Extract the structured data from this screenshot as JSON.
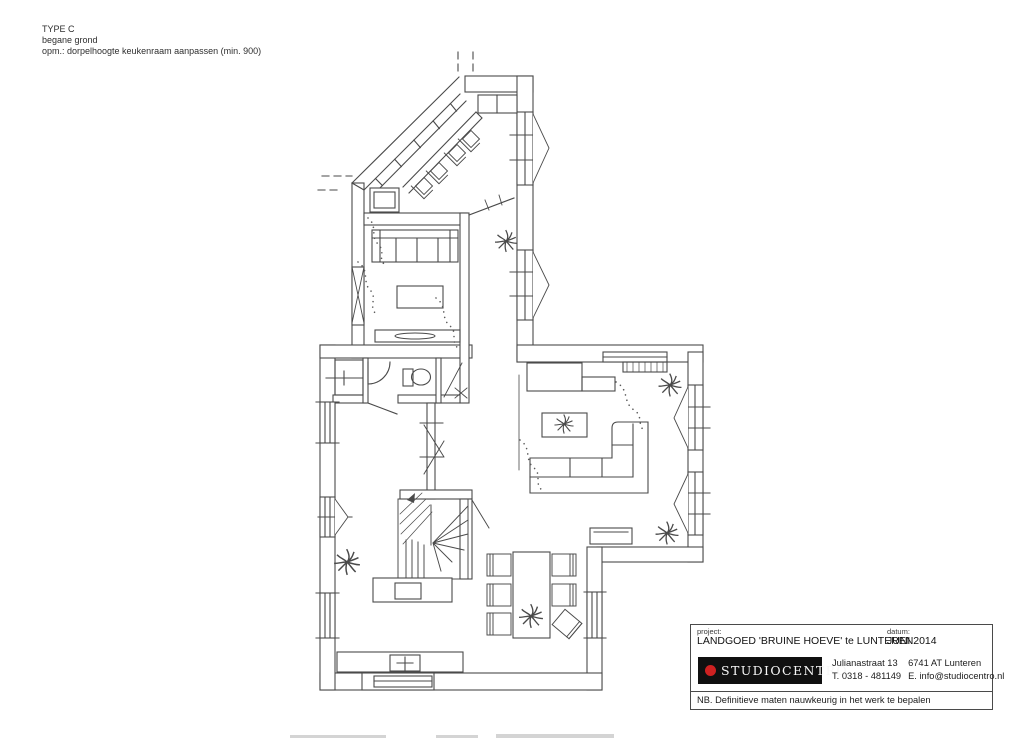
{
  "colors": {
    "paper": "#ffffff",
    "ink": "#4a4a4a",
    "logo_bg": "#101010",
    "logo_dot": "#cf2121",
    "logo_text_color": "#f7f7f7"
  },
  "drawing_note": {
    "type_label": "TYPE C",
    "floor_label": "begane grond",
    "remark": "opm.: dorpelhoogte keukenraam aanpassen (min. 900)"
  },
  "title_block": {
    "project_label": "project:",
    "project_value": "LANDGOED 'BRUINE HOEVE' te LUNTEREN",
    "date_label": "datum:",
    "date_value": "JUNI 2014",
    "logo_text": "STUDIOCENTRO",
    "address_street": "Julianastraat 13",
    "address_phone": "T. 0318 - 481149",
    "address_postal": "6741 AT Lunteren",
    "address_email": "E. info@studiocentro.nl",
    "footer_note": "NB. Definitieve maten nauwkeurig in het werk te bepalen"
  },
  "plan": {
    "kind": "hand-drawn floor plan, ground floor (begane grond), type C",
    "icon_elements": [
      "kitchen-counter",
      "bar-stools",
      "conservatory-glazing",
      "lounge-sofa",
      "coffee-table",
      "tv-sideboard",
      "toilet",
      "meter-cupboard",
      "hall-doors",
      "winder-staircase",
      "dining-table",
      "dining-chairs",
      "corner-sofa",
      "wall-cabinets",
      "radiator",
      "windows",
      "plants",
      "bench",
      "sideboard"
    ]
  }
}
